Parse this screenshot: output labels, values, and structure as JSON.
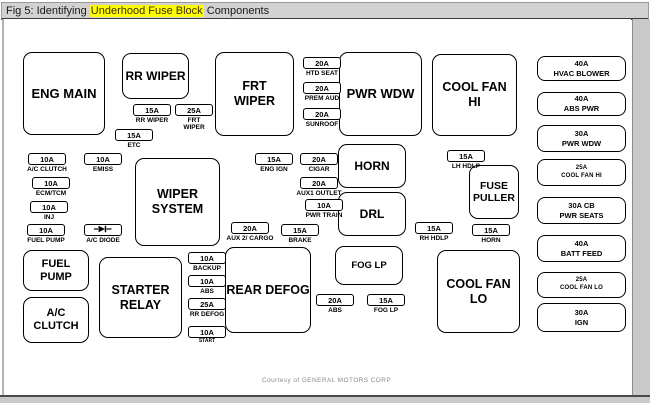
{
  "title": {
    "prefix": "Fig 5: Identifying ",
    "highlight": "Underhood Fuse Block",
    "suffix": " Components"
  },
  "footer": {
    "credit": "Courtesy of GENERAL MOTORS CORP"
  },
  "colors": {
    "highlight_bg": "#ffff00",
    "titlebar_bg": "#d2d2d2",
    "page_bg": "#ffffff",
    "line": "#000000",
    "margin_gray": "#c9c9c9",
    "credit_gray": "#8c8c8c"
  },
  "diagram": {
    "relay_boxes": [
      {
        "lines": [
          "ENG MAIN"
        ],
        "x": 23,
        "y": 52,
        "w": 82,
        "h": 83,
        "fs": 13
      },
      {
        "lines": [
          "RR WIPER"
        ],
        "x": 122,
        "y": 53,
        "w": 67,
        "h": 46,
        "fs": 12
      },
      {
        "lines": [
          "FRT",
          "WIPER"
        ],
        "x": 215,
        "y": 52,
        "w": 79,
        "h": 84,
        "fs": 12.5
      },
      {
        "lines": [
          "PWR WDW"
        ],
        "x": 339,
        "y": 52,
        "w": 83,
        "h": 84,
        "fs": 13
      },
      {
        "lines": [
          "COOL FAN",
          "HI"
        ],
        "x": 432,
        "y": 54,
        "w": 85,
        "h": 82,
        "fs": 12.5
      },
      {
        "lines": [
          "WIPER",
          "SYSTEM"
        ],
        "x": 135,
        "y": 158,
        "w": 85,
        "h": 88,
        "fs": 12.5
      },
      {
        "lines": [
          "HORN"
        ],
        "x": 338,
        "y": 144,
        "w": 68,
        "h": 44,
        "fs": 12
      },
      {
        "lines": [
          "DRL"
        ],
        "x": 338,
        "y": 192,
        "w": 68,
        "h": 44,
        "fs": 12
      },
      {
        "lines": [
          "FOG LP"
        ],
        "x": 335,
        "y": 246,
        "w": 68,
        "h": 39,
        "fs": 9.5
      },
      {
        "lines": [
          "FUSE",
          "PULLER"
        ],
        "x": 469,
        "y": 165,
        "w": 50,
        "h": 54,
        "fs": 10.5
      },
      {
        "lines": [
          "FUEL",
          "PUMP"
        ],
        "x": 23,
        "y": 250,
        "w": 66,
        "h": 41,
        "fs": 11
      },
      {
        "lines": [
          "A/C",
          "CLUTCH"
        ],
        "x": 23,
        "y": 297,
        "w": 66,
        "h": 46,
        "fs": 11
      },
      {
        "lines": [
          "STARTER",
          "RELAY"
        ],
        "x": 99,
        "y": 257,
        "w": 83,
        "h": 81,
        "fs": 12.5
      },
      {
        "lines": [
          "REAR DEFOG"
        ],
        "x": 225,
        "y": 247,
        "w": 86,
        "h": 86,
        "fs": 12.5
      },
      {
        "lines": [
          "COOL FAN",
          "LO"
        ],
        "x": 437,
        "y": 250,
        "w": 83,
        "h": 83,
        "fs": 12.5
      }
    ],
    "maxi_fuses": [
      {
        "amp": "40A",
        "label": "HVAC BLOWER",
        "x": 537,
        "y": 56,
        "w": 89,
        "h": 25,
        "small": false
      },
      {
        "amp": "40A",
        "label": "ABS PWR",
        "x": 537,
        "y": 92,
        "w": 89,
        "h": 24,
        "small": false
      },
      {
        "amp": "30A",
        "label": "PWR WDW",
        "x": 537,
        "y": 125,
        "w": 89,
        "h": 27,
        "small": false
      },
      {
        "amp": "25A",
        "label": "COOL FAN HI",
        "x": 537,
        "y": 159,
        "w": 89,
        "h": 27,
        "small": true
      },
      {
        "amp": "30A CB",
        "label": "PWR SEATS",
        "x": 537,
        "y": 197,
        "w": 89,
        "h": 27,
        "small": false
      },
      {
        "amp": "40A",
        "label": "BATT FEED",
        "x": 537,
        "y": 235,
        "w": 89,
        "h": 27,
        "small": false
      },
      {
        "amp": "25A",
        "label": "COOL FAN LO",
        "x": 537,
        "y": 272,
        "w": 89,
        "h": 26,
        "small": true
      },
      {
        "amp": "30A",
        "label": "IGN",
        "x": 537,
        "y": 303,
        "w": 89,
        "h": 29,
        "small": false
      }
    ],
    "small_fuses": [
      {
        "amp": "15A",
        "label_lines": [
          "RR WIPER"
        ],
        "x": 133,
        "y": 104
      },
      {
        "amp": "25A",
        "label_lines": [
          "FRT",
          "WIPER"
        ],
        "x": 175,
        "y": 104
      },
      {
        "amp": "15A",
        "label_lines": [
          "ETC"
        ],
        "x": 115,
        "y": 129
      },
      {
        "amp": "20A",
        "label_lines": [
          "HTD SEAT"
        ],
        "x": 303,
        "y": 57
      },
      {
        "amp": "20A",
        "label_lines": [
          "PREM AUD"
        ],
        "x": 303,
        "y": 82
      },
      {
        "amp": "20A",
        "label_lines": [
          "SUNROOF"
        ],
        "x": 303,
        "y": 108
      },
      {
        "amp": "10A",
        "label_lines": [
          "A/C CLUTCH"
        ],
        "x": 28,
        "y": 153
      },
      {
        "amp": "10A",
        "label_lines": [
          "EMISS"
        ],
        "x": 84,
        "y": 153
      },
      {
        "amp": "10A",
        "label_lines": [
          "ECM/TCM"
        ],
        "x": 32,
        "y": 177
      },
      {
        "amp": "10A",
        "label_lines": [
          "INJ"
        ],
        "x": 30,
        "y": 201
      },
      {
        "amp": "10A",
        "label_lines": [
          "FUEL PUMP"
        ],
        "x": 27,
        "y": 224
      },
      {
        "glyph": "diode",
        "label_lines": [
          "A/C DIODE"
        ],
        "x": 84,
        "y": 224
      },
      {
        "amp": "15A",
        "label_lines": [
          "ENG IGN"
        ],
        "x": 255,
        "y": 153
      },
      {
        "amp": "20A",
        "label_lines": [
          "CIGAR"
        ],
        "x": 300,
        "y": 153
      },
      {
        "amp": "20A",
        "label_lines": [
          "AUX1 OUTLET"
        ],
        "x": 300,
        "y": 177
      },
      {
        "amp": "10A",
        "label_lines": [
          "PWR TRAIN"
        ],
        "x": 305,
        "y": 199
      },
      {
        "amp": "20A",
        "label_lines": [
          "AUX 2/ CARGO"
        ],
        "x": 231,
        "y": 222
      },
      {
        "amp": "15A",
        "label_lines": [
          "BRAKE"
        ],
        "x": 281,
        "y": 224
      },
      {
        "amp": "15A",
        "label_lines": [
          "LH HDLP"
        ],
        "x": 447,
        "y": 150
      },
      {
        "amp": "15A",
        "label_lines": [
          "RH HDLP"
        ],
        "x": 415,
        "y": 222
      },
      {
        "amp": "15A",
        "label_lines": [
          "HORN"
        ],
        "x": 472,
        "y": 224
      },
      {
        "amp": "10A",
        "label_lines": [
          "BACKUP"
        ],
        "x": 188,
        "y": 252
      },
      {
        "amp": "10A",
        "label_lines": [
          "ABS"
        ],
        "x": 188,
        "y": 275
      },
      {
        "amp": "25A",
        "label_lines": [
          "RR DEFOG"
        ],
        "x": 188,
        "y": 298
      },
      {
        "amp": "10A",
        "label_lines": [
          "START"
        ],
        "x": 188,
        "y": 326,
        "small_label": true
      },
      {
        "amp": "20A",
        "label_lines": [
          "ABS"
        ],
        "x": 316,
        "y": 294
      },
      {
        "amp": "15A",
        "label_lines": [
          "FOG LP"
        ],
        "x": 367,
        "y": 294
      }
    ]
  }
}
